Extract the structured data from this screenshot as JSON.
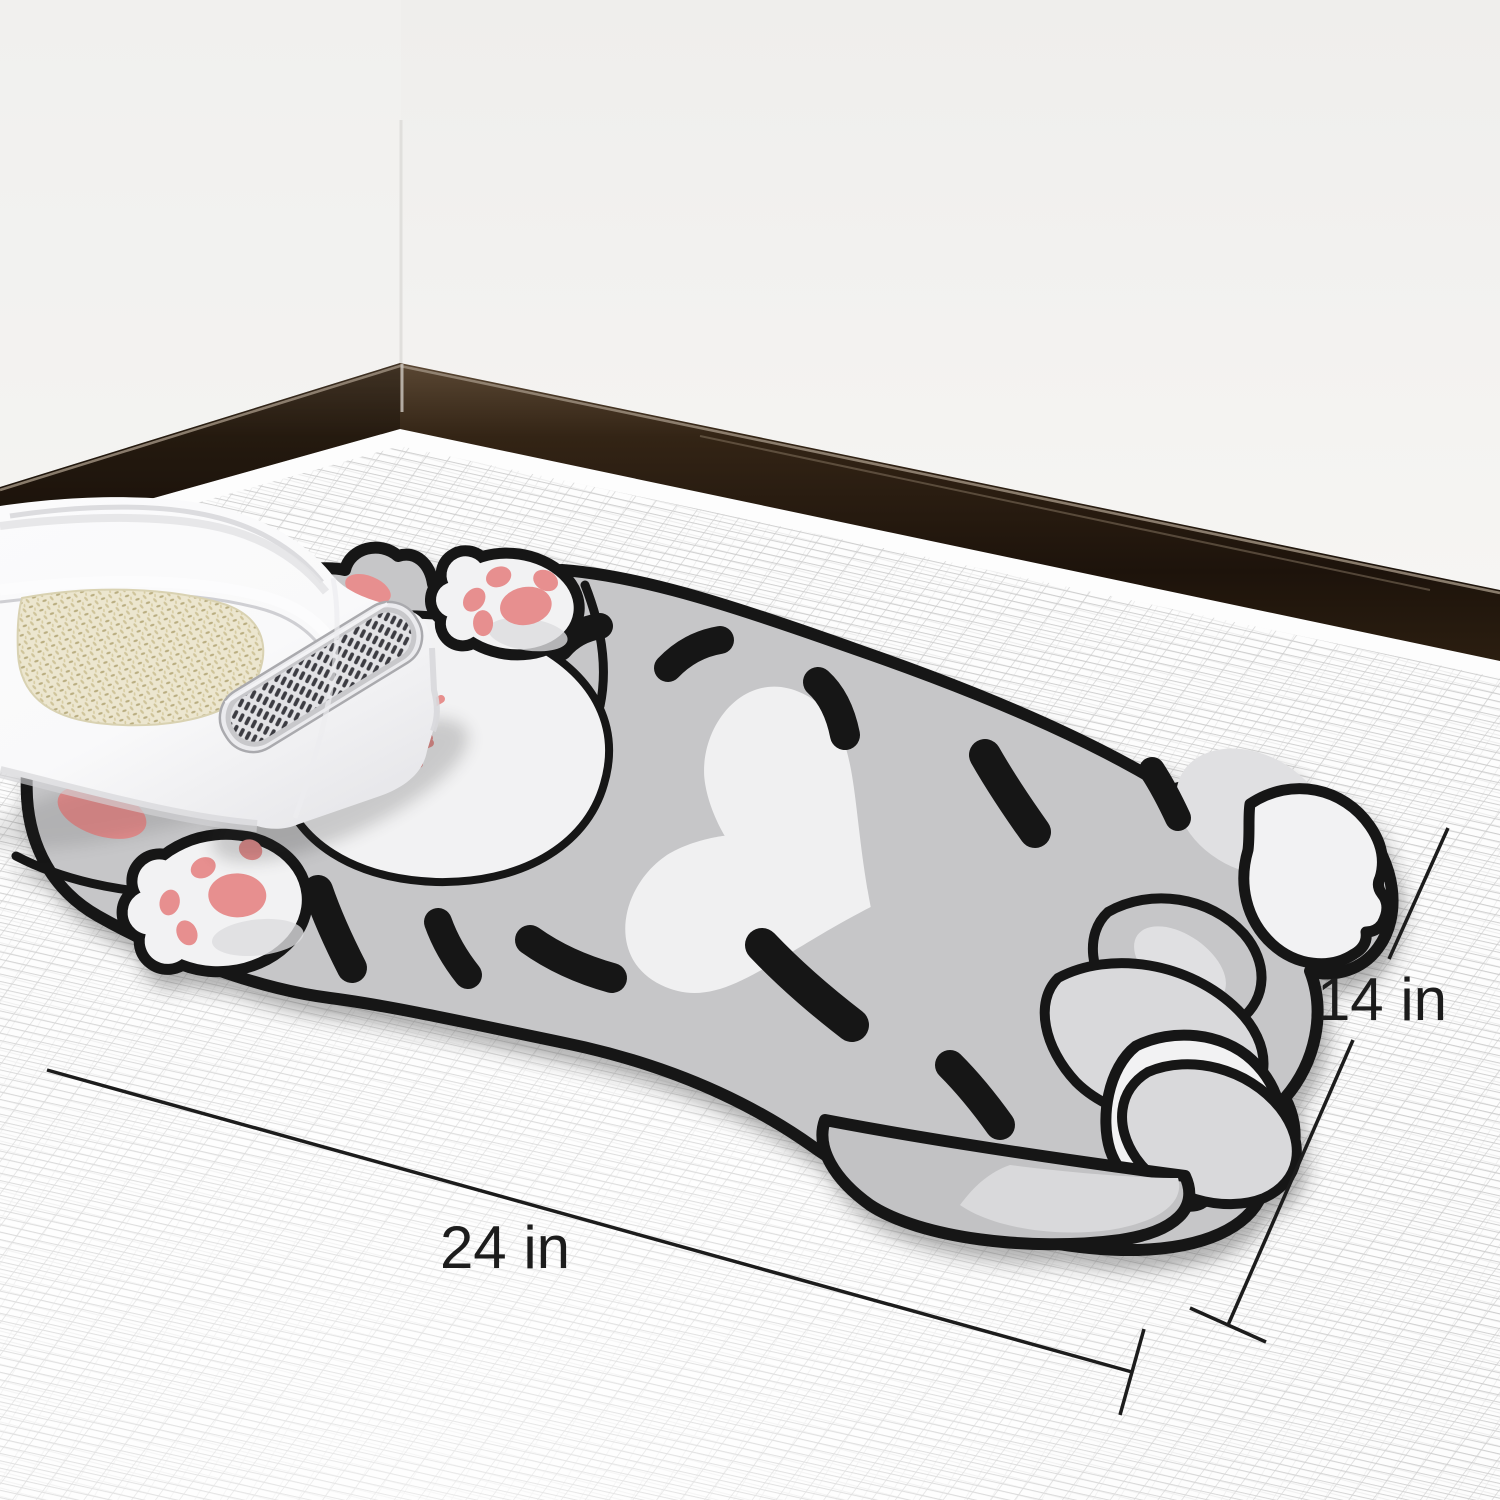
{
  "dimensions": {
    "width": {
      "label": "24 in",
      "value": 24,
      "unit": "in"
    },
    "height": {
      "label": "14 in",
      "value": 14,
      "unit": "in"
    }
  },
  "colors": {
    "wall": "#f3f2f0",
    "wall_corner": "#e0dfdc",
    "baseboard_dark": "#1d130b",
    "baseboard_mid": "#3a2c1d",
    "baseboard_sheen": "#9b8d7c",
    "floor": "#fdfdfd",
    "mesh_line": "#c6c6c6",
    "cat_body": "#c6c6c8",
    "cat_tail": "#c2c2c4",
    "cat_outline": "#161616",
    "cat_white": "#f2f2f3",
    "cat_light": "#e0e0e2",
    "cat_leg_light": "#d9d9db",
    "paw_pink": "#e78f8f",
    "mouth_pink": "#e78f8d",
    "litter_beige": "#ece6cf",
    "litter_grain": "#b9ad80",
    "box_white": "#f9f9fa",
    "box_shade": "#d6d6d9",
    "grate_frame": "#ebebee",
    "grate_slat": "#3c3c42",
    "dimension_ink": "#1c1c1c"
  }
}
